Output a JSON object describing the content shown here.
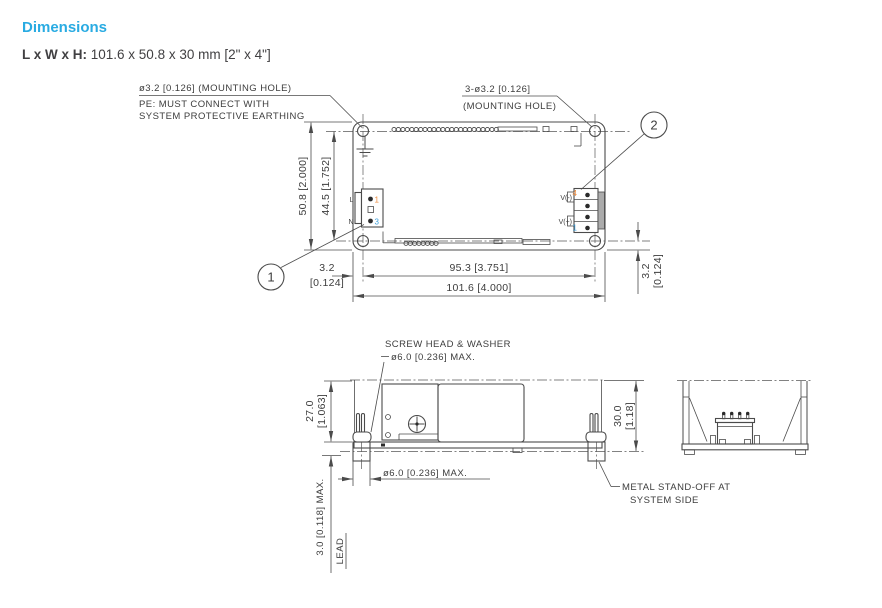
{
  "header": {
    "title": "Dimensions",
    "size_label": "L x W x H:",
    "size_value": " 101.6 x 50.8 x 30 mm [2\" x 4\"]"
  },
  "colors": {
    "accent": "#29abe2",
    "drawing_line": "#4b4b4b",
    "pin_orange": "#ee8a3b",
    "pin_blue": "#3ea0dc"
  },
  "top_view": {
    "callout_hole_left": "ø3.2 [0.126] (MOUNTING HOLE)",
    "callout_pe_1": "PE: MUST CONNECT WITH",
    "callout_pe_2": "SYSTEM PROTECTIVE EARTHING",
    "callout_hole_right_1": "3-ø3.2 [0.126]",
    "callout_hole_right_2": "(MOUNTING HOLE)",
    "balloon_1": "1",
    "balloon_2": "2",
    "label_line": "L",
    "label_neutral": "N",
    "pin_in_top": "1",
    "pin_in_bottom": "3",
    "label_v_minus": "V(-)",
    "pin_v_minus": "4",
    "label_v_plus": "V(+)",
    "pin_v_plus": "1",
    "dim_height": "50.8 [2.000]",
    "dim_hole_height": "44.5 [1.752]",
    "dim_offset_left_mm": "3.2",
    "dim_offset_left_in": "[0.124]",
    "dim_hole_width": "95.3 [3.751]",
    "dim_width": "101.6 [4.000]",
    "dim_offset_right_mm": "3.2",
    "dim_offset_right_in": "[0.124]"
  },
  "side_view": {
    "callout_screw_1": "SCREW HEAD & WASHER",
    "callout_screw_2": "ø6.0 [0.236] MAX.",
    "dim_height_mm": "27.0",
    "dim_height_in": "[1.063]",
    "dim_total_mm": "30.0",
    "dim_total_in": "[1.18]",
    "dim_standoff_dia": "ø6.0 [0.236] MAX.",
    "dim_lead_max": "3.0 [0.118] MAX.",
    "label_lead": "LEAD",
    "callout_standoff_1": "METAL STAND-OFF AT",
    "callout_standoff_2": "SYSTEM SIDE"
  }
}
